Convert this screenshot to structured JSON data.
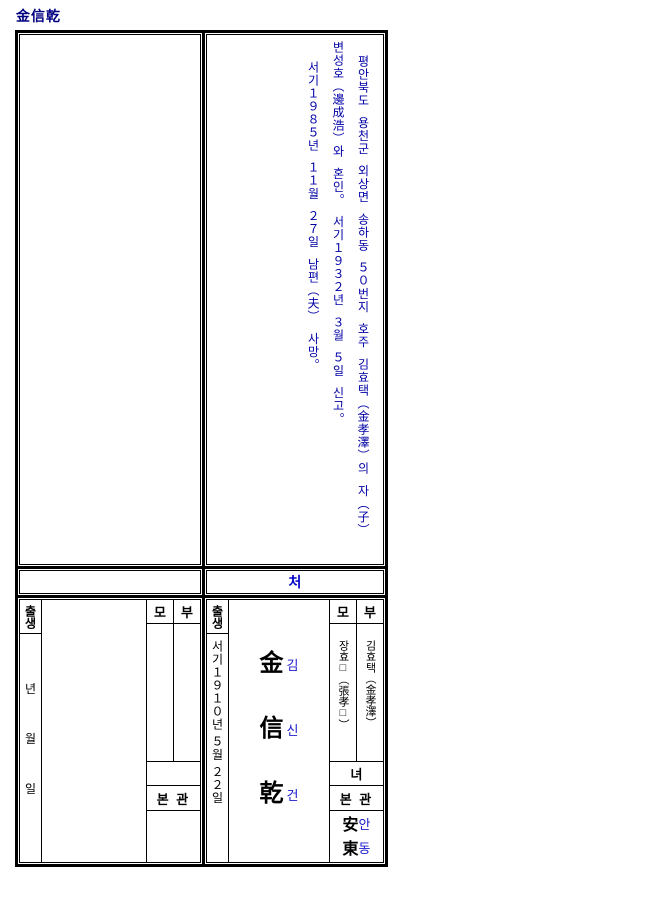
{
  "document": {
    "title": "金信乾"
  },
  "colors": {
    "title_navy": "#000080",
    "event_text_blue": "#0000A6",
    "hangul_annotation_blue": "#1A1ACC",
    "wife_label_blue": "#0000CC",
    "border_black": "#000000"
  },
  "events_cell": {
    "entries": [
      "평안북도 용천군 외상면 송하동 ５０번지 호주 김효택（金孝澤）의 자（子）",
      "변성호（邊成浩）와 혼인。 서기１９３２년 ３월 ５일 신고。",
      "서기１９８５년 １１월 ２７일 남편（夫） 사망。"
    ]
  },
  "wife_row": {
    "label": "처"
  },
  "left_block": {
    "birth_label": "출생",
    "date_units": [
      "년",
      "월",
      "일"
    ],
    "mother_label": "모",
    "father_label": "부",
    "clan_label": "본 관"
  },
  "right_block": {
    "birth_label": "출생",
    "birth_date": "서기１９１０년 ５월 ２２일",
    "name": {
      "hanja": [
        "金",
        "信",
        "乾"
      ],
      "hangul": [
        "김",
        "신",
        "건"
      ]
    },
    "mother_label": "모",
    "father_label": "부",
    "mother_name": "장효□（張孝□）",
    "father_name": "김효택（金孝澤）",
    "relation_label": "녀",
    "clan_label": "본 관",
    "clan_name": [
      {
        "hanja": "安",
        "hangul": "안"
      },
      {
        "hanja": "東",
        "hangul": "동"
      }
    ]
  }
}
